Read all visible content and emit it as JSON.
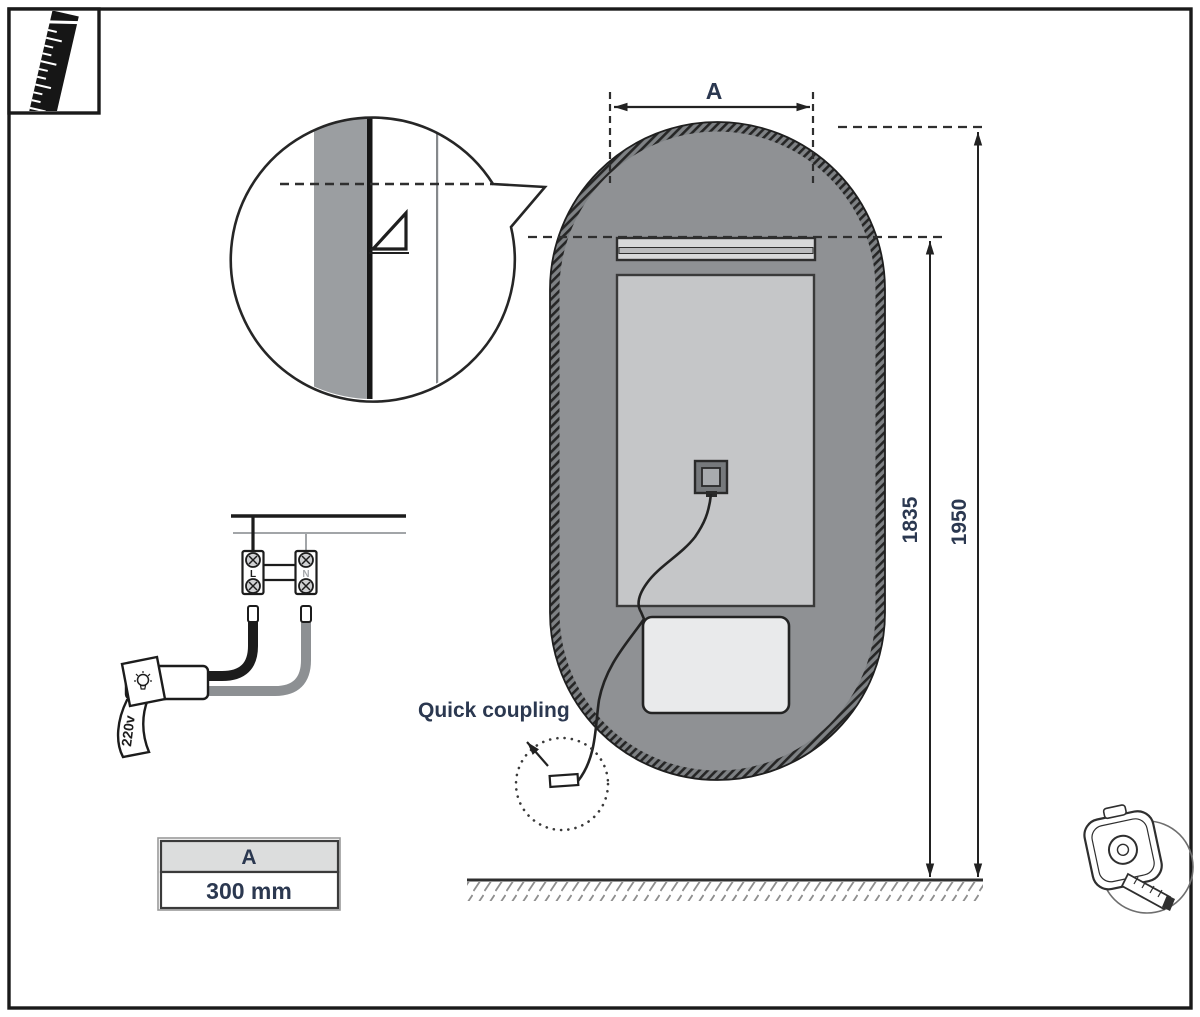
{
  "dimensions": {
    "width_label": "A",
    "bracket_height": "1835",
    "total_height": "1950"
  },
  "size_table": {
    "header": "A",
    "value": "300 mm"
  },
  "coupling": {
    "label": "Quick coupling"
  },
  "wiring": {
    "terminal_live": "L",
    "terminal_neutral": "N",
    "voltage_tag": "220v"
  },
  "colors": {
    "label_text": "#2b3850",
    "heater_fill": "#8f9194",
    "panel_fill": "#c5c6c8",
    "rail_fill": "#d8d9da",
    "rail_band_fill": "#bbbcbe",
    "junction_box_fill": "#e9eaeb",
    "wall_band_fill": "#9b9ea1",
    "table_header_fill": "#dcdddd",
    "outline": "#222222"
  },
  "icons": {
    "top_left": "ruler-icon",
    "bottom_right": "tape-measure-icon",
    "voltage_flag": "bulb-icon"
  }
}
